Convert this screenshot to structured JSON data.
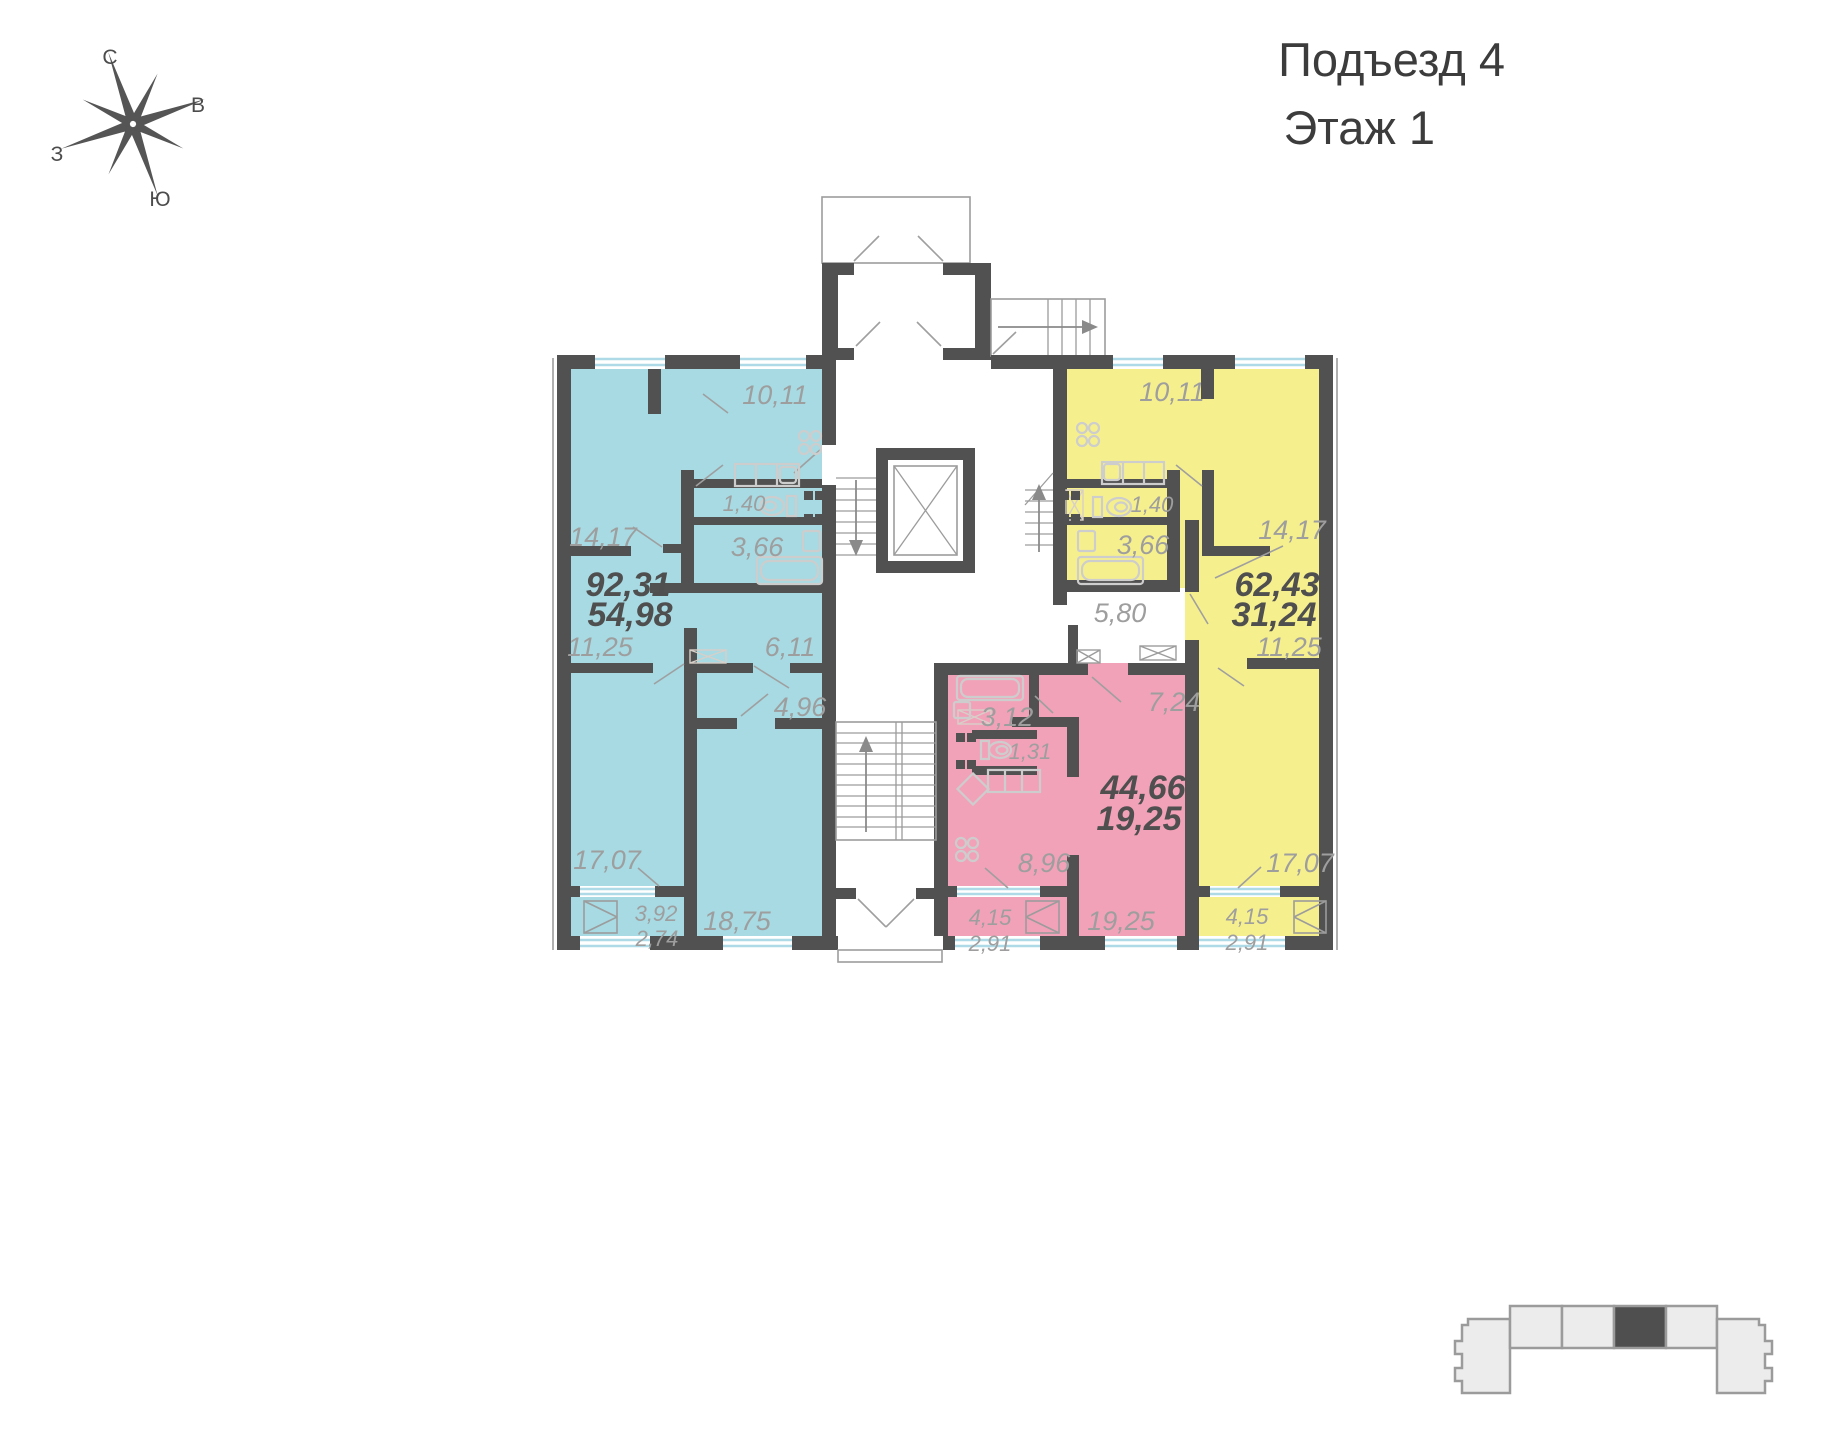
{
  "header": {
    "entrance": "Подъезд 4",
    "floor": "Этаж 1"
  },
  "compass": {
    "north": "С",
    "east": "В",
    "west": "З",
    "south": "Ю"
  },
  "colors": {
    "apartment_left_fill": "#a7dae3",
    "apartment_center_fill": "#f2a2b8",
    "apartment_right_fill": "#f6ef8e",
    "wall": "#515151",
    "room_label": "#9e9e9e",
    "total_label": "#4f4f4f",
    "window_glass": "#aed9e6",
    "highlight_section": "#4f4f4f"
  },
  "apartments": [
    {
      "id": "left",
      "fill": "#a7dae3",
      "total_area": "92,31",
      "living_area": "54,98"
    },
    {
      "id": "center",
      "fill": "#f2a2b8",
      "total_area": "44,66",
      "living_area": "19,25"
    },
    {
      "id": "right",
      "fill": "#f6ef8e",
      "total_area": "62,43",
      "living_area": "31,24"
    }
  ],
  "common_areas": {
    "corridor_area": "5,80"
  },
  "building_overview": {
    "sections_total": 6,
    "highlighted_section_index": 4
  },
  "plan_labels": [
    {
      "name": "apt-left-kitchen",
      "text": "10,11",
      "x": 775,
      "y": 404,
      "cls": "lbl room"
    },
    {
      "name": "apt-left-room-1",
      "text": "14,17",
      "x": 603,
      "y": 546,
      "cls": "lbl room"
    },
    {
      "name": "apt-left-wc",
      "text": "1,40",
      "x": 744,
      "y": 511,
      "cls": "lbl small"
    },
    {
      "name": "apt-left-bath",
      "text": "3,66",
      "x": 757,
      "y": 556,
      "cls": "lbl room"
    },
    {
      "name": "apt-left-total",
      "text": "92,31",
      "x": 628,
      "y": 596,
      "cls": "lbl total"
    },
    {
      "name": "apt-left-living",
      "text": "54,98",
      "x": 630,
      "y": 626,
      "cls": "lbl total"
    },
    {
      "name": "apt-left-room-2",
      "text": "11,25",
      "x": 600,
      "y": 656,
      "cls": "lbl room"
    },
    {
      "name": "apt-left-hall-1",
      "text": "6,11",
      "x": 790,
      "y": 656,
      "cls": "lbl room"
    },
    {
      "name": "apt-left-hall-2",
      "text": "4,96",
      "x": 800,
      "y": 716,
      "cls": "lbl room"
    },
    {
      "name": "apt-left-room-3",
      "text": "17,07",
      "x": 607,
      "y": 869,
      "cls": "lbl room"
    },
    {
      "name": "apt-left-balcony-a",
      "text": "3,92",
      "x": 656,
      "y": 921,
      "cls": "lbl small"
    },
    {
      "name": "apt-left-balcony-b",
      "text": "2,74",
      "x": 657,
      "y": 946,
      "cls": "lbl small"
    },
    {
      "name": "apt-left-room-4",
      "text": "18,75",
      "x": 737,
      "y": 930,
      "cls": "lbl room"
    },
    {
      "name": "apt-center-bath",
      "text": "3,12",
      "x": 1007,
      "y": 726,
      "cls": "lbl room"
    },
    {
      "name": "apt-center-hall",
      "text": "7,24",
      "x": 1174,
      "y": 711,
      "cls": "lbl room"
    },
    {
      "name": "apt-center-wc",
      "text": "1,31",
      "x": 1030,
      "y": 759,
      "cls": "lbl small"
    },
    {
      "name": "apt-center-total",
      "text": "44,66",
      "x": 1143,
      "y": 799,
      "cls": "lbl total"
    },
    {
      "name": "apt-center-living",
      "text": "19,25",
      "x": 1139,
      "y": 830,
      "cls": "lbl total"
    },
    {
      "name": "apt-center-kitchen",
      "text": "8,96",
      "x": 1044,
      "y": 872,
      "cls": "lbl room"
    },
    {
      "name": "apt-center-balcony-a",
      "text": "4,15",
      "x": 990,
      "y": 925,
      "cls": "lbl small"
    },
    {
      "name": "apt-center-balcony-b",
      "text": "2,91",
      "x": 990,
      "y": 951,
      "cls": "lbl small"
    },
    {
      "name": "apt-center-room",
      "text": "19,25",
      "x": 1121,
      "y": 930,
      "cls": "lbl room"
    },
    {
      "name": "apt-right-kitchen",
      "text": "10,11",
      "x": 1172,
      "y": 401,
      "cls": "lbl room"
    },
    {
      "name": "apt-right-wc",
      "text": "1,40",
      "x": 1152,
      "y": 512,
      "cls": "lbl small"
    },
    {
      "name": "apt-right-bath",
      "text": "3,66",
      "x": 1143,
      "y": 554,
      "cls": "lbl room"
    },
    {
      "name": "apt-right-room-1",
      "text": "14,17",
      "x": 1292,
      "y": 539,
      "cls": "lbl room"
    },
    {
      "name": "apt-right-total",
      "text": "62,43",
      "x": 1277,
      "y": 596,
      "cls": "lbl total"
    },
    {
      "name": "apt-right-living",
      "text": "31,24",
      "x": 1274,
      "y": 626,
      "cls": "lbl total"
    },
    {
      "name": "apt-right-room-2",
      "text": "11,25",
      "x": 1289,
      "y": 656,
      "cls": "lbl room"
    },
    {
      "name": "apt-right-room-3",
      "text": "17,07",
      "x": 1300,
      "y": 872,
      "cls": "lbl room"
    },
    {
      "name": "apt-right-balcony-a",
      "text": "4,15",
      "x": 1247,
      "y": 924,
      "cls": "lbl small"
    },
    {
      "name": "apt-right-balcony-b",
      "text": "2,91",
      "x": 1247,
      "y": 950,
      "cls": "lbl small"
    },
    {
      "name": "common-corridor",
      "text": "5,80",
      "x": 1120,
      "y": 622,
      "cls": "lbl room"
    }
  ]
}
